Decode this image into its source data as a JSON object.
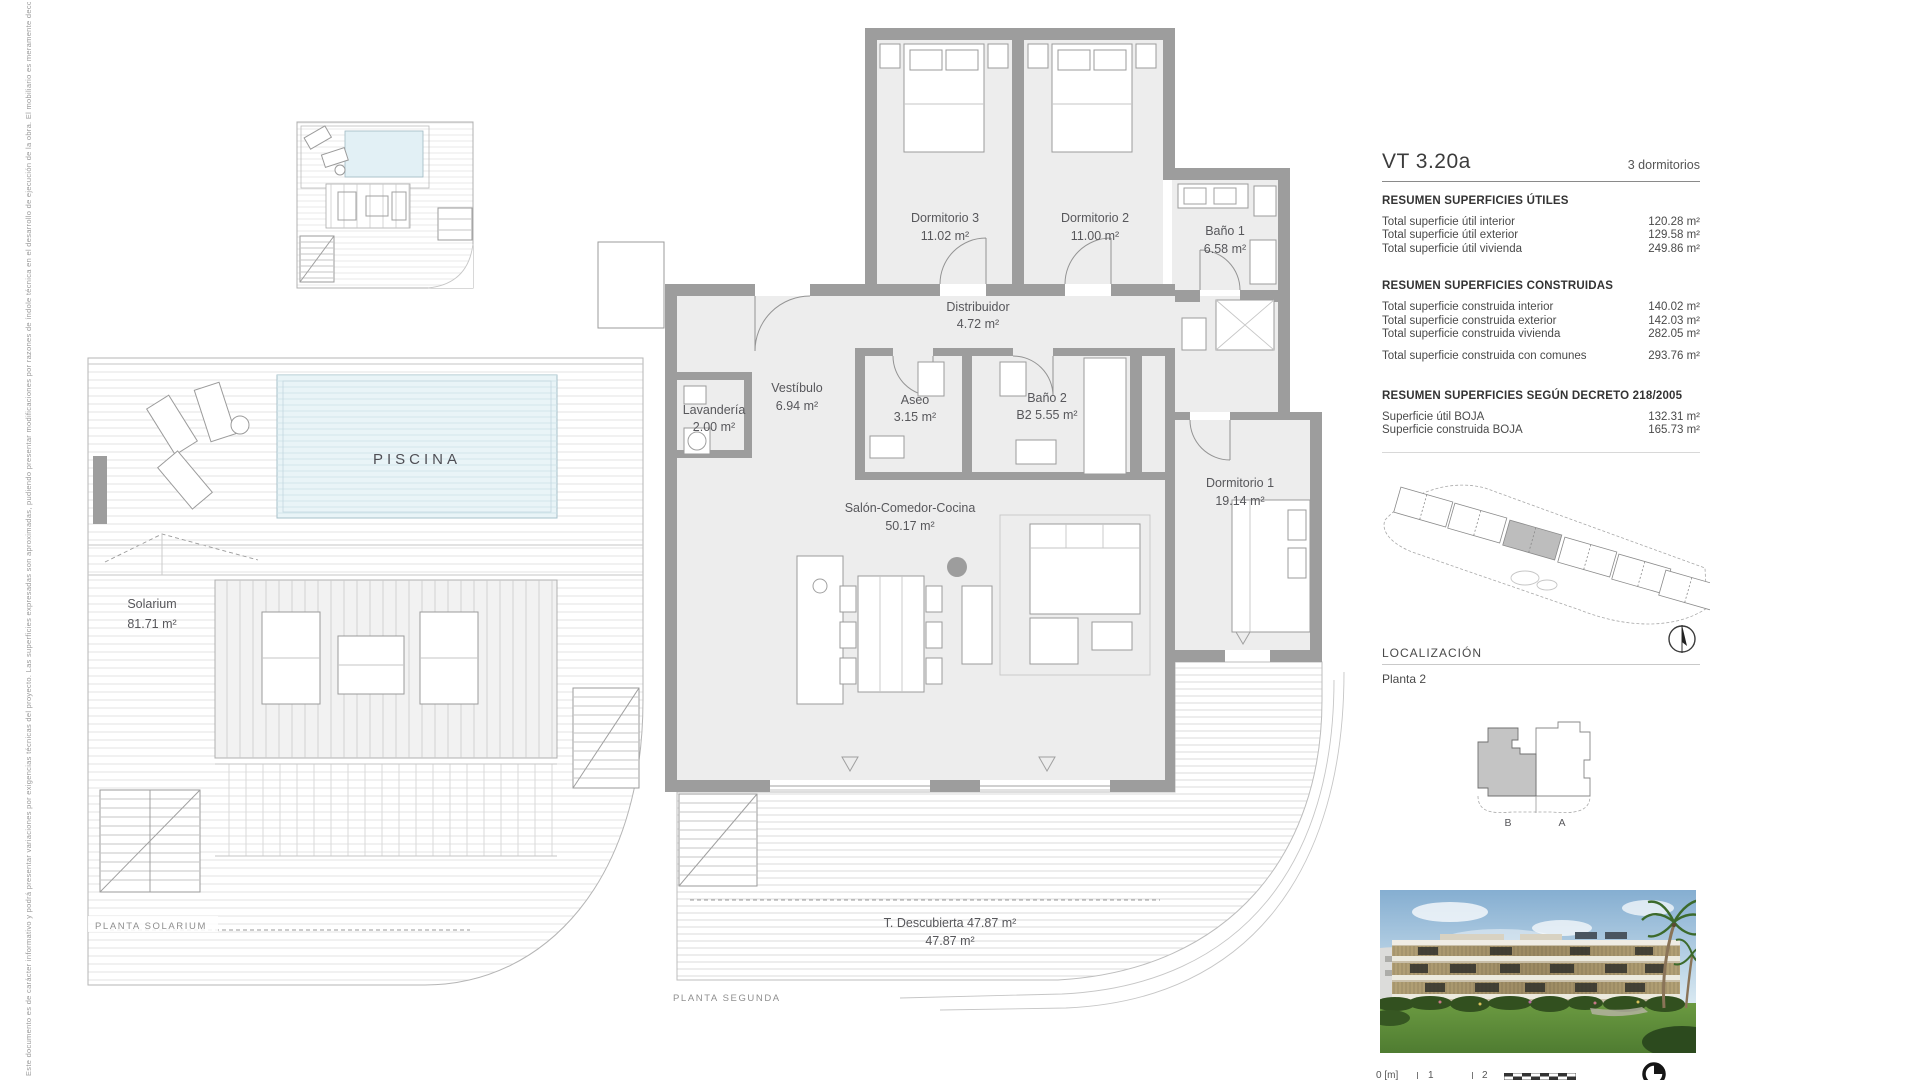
{
  "disclaimer": {
    "text": "Este documento es de carácter informativo y podrá presentar variaciones por exigencias técnicas del proyecto. Las superficies expresadas son aproximadas, pudiendo presentar modificaciones por razones de índole técnica en el desarrollo de ejecución de la obra. El mobiliario es meramente decorativo y los acabados, zonas ajardinadas y equipamiento se muestran a título orientativo según el desarrollo de ejecución de la obra."
  },
  "watermark": "Spain",
  "solarium_plan": {
    "piscina_label": "PISCINA",
    "solarium_label": "Solarium",
    "solarium_area": "81.71 m²",
    "caption": "PLANTA SOLARIUM"
  },
  "main_plan": {
    "caption": "PLANTA SEGUNDA",
    "rooms": [
      {
        "name": "Dormitorio 3",
        "area": "11.02 m²"
      },
      {
        "name": "Dormitorio 2",
        "area": "11.00 m²"
      },
      {
        "name": "Baño 1",
        "area": "6.58 m²"
      },
      {
        "name": "Distribuidor",
        "area": "4.72 m²"
      },
      {
        "name": "Vestíbulo",
        "area": "6.94 m²"
      },
      {
        "name": "Lavandería",
        "area": "2.00 m²"
      },
      {
        "name": "Aseo",
        "area": "3.15 m²"
      },
      {
        "name": "Baño 2",
        "area": "B2 5.55 m²"
      },
      {
        "name": "Salón-Comedor-Cocina",
        "area": "50.17 m²"
      },
      {
        "name": "Dormitorio 1",
        "area": "19.14 m²"
      },
      {
        "name": "T. Descubierta 47.87 m²",
        "area": "47.87 m²"
      }
    ]
  },
  "panel": {
    "unit_code": "VT 3.20a",
    "unit_type": "3 dormitorios",
    "sections": [
      {
        "heading": "RESUMEN SUPERFICIES ÚTILES",
        "rows": [
          {
            "label": "Total superficie útil interior",
            "value": "120.28 m²"
          },
          {
            "label": "Total superficie útil exterior",
            "value": "129.58 m²"
          },
          {
            "label": "Total superficie útil vivienda",
            "value": "249.86 m²"
          }
        ]
      },
      {
        "heading": "RESUMEN SUPERFICIES CONSTRUIDAS",
        "rows": [
          {
            "label": "Total superficie construida interior",
            "value": "140.02 m²"
          },
          {
            "label": "Total superficie construida exterior",
            "value": "142.03 m²"
          },
          {
            "label": "Total superficie construida vivienda",
            "value": "282.05 m²"
          },
          {
            "label": "Total superficie construida con comunes",
            "value": "293.76 m²"
          }
        ]
      },
      {
        "heading": "RESUMEN SUPERFICIES SEGÚN DECRETO 218/2005",
        "rows": [
          {
            "label": "Superficie útil BOJA",
            "value": "132.31 m²"
          },
          {
            "label": "Superficie construida BOJA",
            "value": "165.73 m²"
          }
        ]
      }
    ],
    "localizacion": {
      "heading": "LOCALIZACIÓN",
      "value": "Planta 2"
    },
    "keyplan": {
      "left_unit": "B",
      "right_unit": "A"
    },
    "scalebar": {
      "zero": "0 [m]",
      "one": "1",
      "two": "2"
    }
  },
  "colors": {
    "wall_gray": "#9d9d9d",
    "floor_gray": "#ededed",
    "pool_blue": "#e9f4f7",
    "keyplan_highlight": "#c4c4c4"
  }
}
